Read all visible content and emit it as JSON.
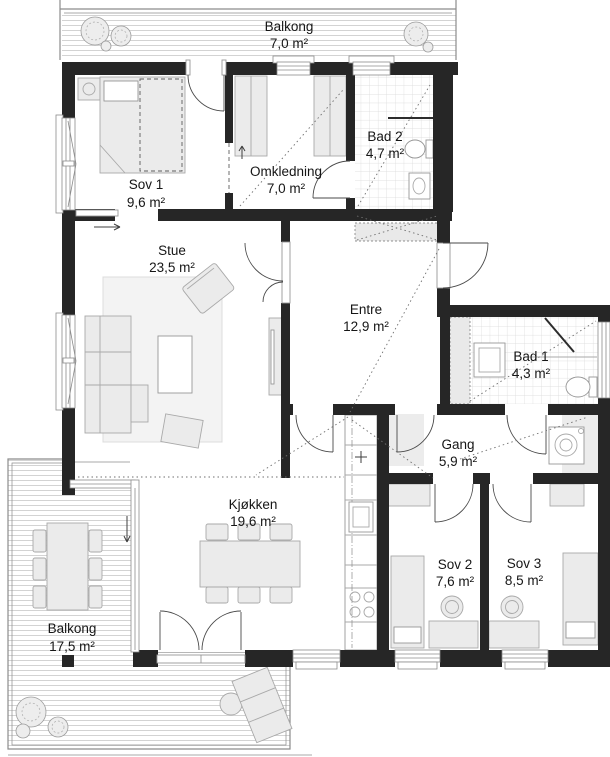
{
  "rooms": {
    "balkong_top": {
      "name": "Balkong",
      "area": "7,0 m²"
    },
    "sov1": {
      "name": "Sov 1",
      "area": "9,6 m²"
    },
    "omkledning": {
      "name": "Omkledning",
      "area": "7,0 m²"
    },
    "bad2": {
      "name": "Bad 2",
      "area": "4,7 m²"
    },
    "stue": {
      "name": "Stue",
      "area": "23,5 m²"
    },
    "entre": {
      "name": "Entre",
      "area": "12,9 m²"
    },
    "bad1": {
      "name": "Bad 1",
      "area": "4,3 m²"
    },
    "gang": {
      "name": "Gang",
      "area": "5,9 m²"
    },
    "kjokken": {
      "name": "Kjøkken",
      "area": "19,6 m²"
    },
    "sov2": {
      "name": "Sov 2",
      "area": "7,6 m²"
    },
    "sov3": {
      "name": "Sov 3",
      "area": "8,5 m²"
    },
    "balkong_bottom": {
      "name": "Balkong",
      "area": "17,5 m²"
    }
  },
  "colors": {
    "wall": "#262626",
    "floor": "#ffffff",
    "furniture_fill": "#ebebeb",
    "furniture_stroke": "#a9a9a9",
    "deck_line": "#c8c8c8",
    "tile_line": "#d8d8d8",
    "outline": "#8c8c8c",
    "door_arc": "#4a4a4a",
    "dotted_line": "#6f6f6f",
    "text": "#161616"
  }
}
